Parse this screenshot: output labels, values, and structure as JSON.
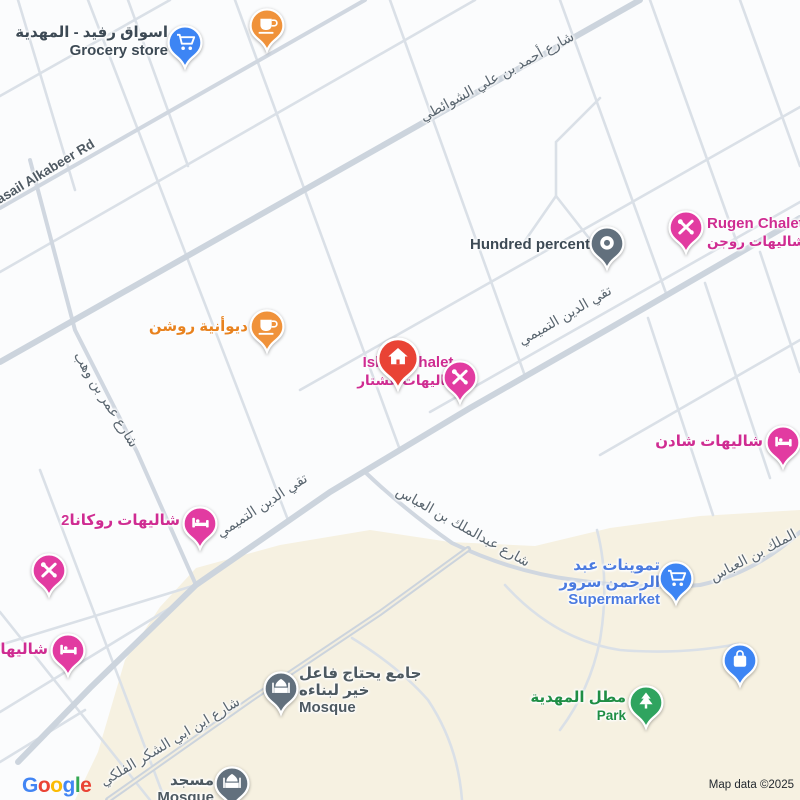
{
  "map": {
    "attribution": "Map data ©2025",
    "logo_letters": [
      "G",
      "o",
      "o",
      "g",
      "l",
      "e"
    ],
    "logo_colors": [
      "#4285F4",
      "#EA4335",
      "#FBBC05",
      "#4285F4",
      "#34A853",
      "#EA4335"
    ],
    "colors": {
      "parcel_beige": "#f6f1e1",
      "road_minor": "#dae0e7",
      "road_medium": "#d0d7e0",
      "road_major": "#ccd4dd",
      "poi_pink": "#e23ba1",
      "poi_orange": "#f0923a",
      "poi_blue": "#3d85f4",
      "poi_red": "#e94335",
      "poi_green": "#2fa45f",
      "poi_slate": "#62707d"
    }
  },
  "road_labels": {
    "ahmad_shawanti": "شارع أحمد بن علي الشوائطي",
    "wasail_alkabeer": "Wasail Alkabeer Rd",
    "taqi_aldin_1": "تقي الدين التميمي",
    "taqi_aldin_2": "تقي الدين التميمي",
    "omar_bin_wahb": "شارع عمر بن وهب",
    "abdulmalik_abbas": "شارع عبدالملك بن العباس",
    "abdulmalik_abbas_2": "الملك بن العباس",
    "ibn_abi_alshukr": "شارع ابن ابي الشكر الفلكي"
  },
  "pois": {
    "rafid_grocery": {
      "name_ar": "اسواق رفيد - المهدية",
      "type_en": "Grocery store",
      "icon": "shopping-cart"
    },
    "cafe_unlabeled": {
      "icon": "coffee-cup"
    },
    "hundred_percent": {
      "name_en": "Hundred percent",
      "icon": "circle-ring"
    },
    "rugen_chalet": {
      "name_en": "Rugen Chalet",
      "name_ar": "شاليهات روجن",
      "icon": "crossed-tools"
    },
    "roshan_diwaniya": {
      "name_ar": "ديوأنية روشن",
      "icon": "coffee-cup"
    },
    "ishtar_chalet": {
      "name_en": "Ishtar Chalet",
      "name_ar": "شاليهات عشتار",
      "marker_icon": "house",
      "icon": "crossed-tools"
    },
    "shaden_chalets": {
      "name_ar": "شاليهات شادن",
      "icon": "bed"
    },
    "rokana2_chalets": {
      "name_ar": "شاليهات روكانا2",
      "icon": "bed"
    },
    "tools_unlabeled": {
      "icon": "crossed-tools"
    },
    "chalets_left": {
      "name_ar": "شاليهات",
      "icon": "bed"
    },
    "surur_supermarket": {
      "name_ar_1": "تموينات عبد",
      "name_ar_2": "الرحمن سرور",
      "type_en": "Supermarket",
      "icon": "shopping-cart"
    },
    "mosque_charity": {
      "name_ar_1": "جامع يحتاج فاعل",
      "name_ar_2": "خير لبناءه",
      "type_en": "Mosque",
      "icon": "mosque"
    },
    "mahdiya_viewpoint": {
      "name_ar": "مطل المهدية",
      "type_en": "Park",
      "icon": "tree"
    },
    "bag_unlabeled": {
      "icon": "shopping-bag"
    },
    "mosque_south": {
      "name_ar": "مسجد",
      "type_en": "Mosque",
      "icon": "mosque"
    }
  }
}
